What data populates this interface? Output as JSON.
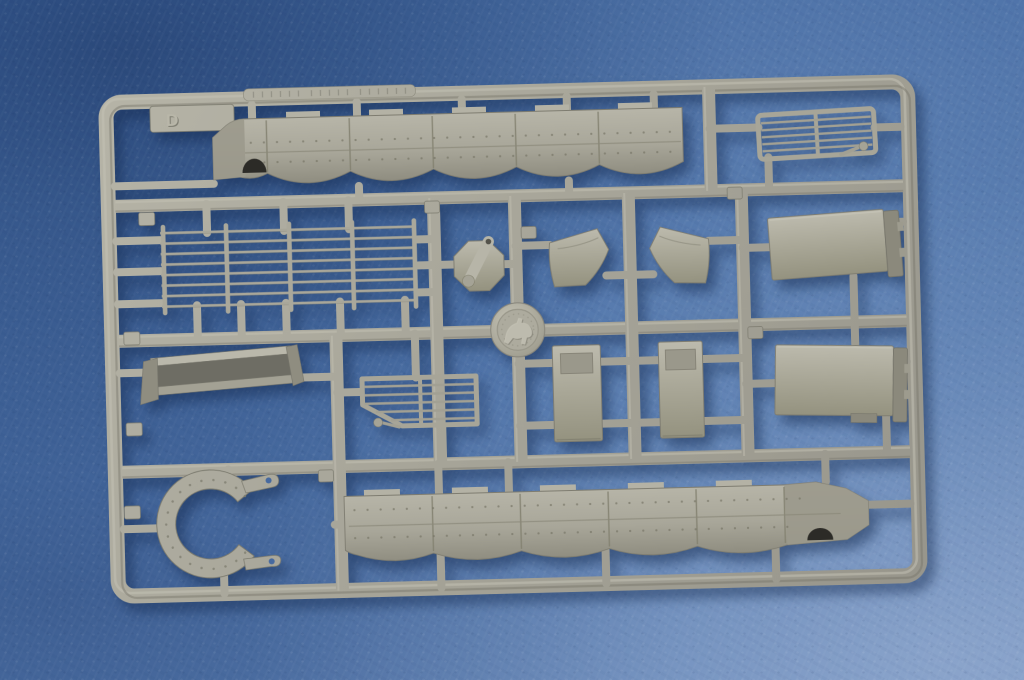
{
  "photo": {
    "subject": "Plastic model-kit parts sprue (runner D) molded in grey styrene, photographed on a mottled blue backdrop",
    "background_color": "#4e73a9",
    "plastic_color": "#a6a498",
    "shadow_color": "#24477f"
  },
  "sprue": {
    "letter": "D",
    "embossed_code_on_top_rail": "illegible",
    "part_number_tag_count": 9,
    "parts": [
      {
        "id": "side-skirt-upper",
        "label": "Segmented side-skirt armour strip, six panels, angled end with dark cable cutout"
      },
      {
        "id": "engine-grille-right",
        "label": "Slatted engine grille with small bracket"
      },
      {
        "id": "mesh-rack",
        "label": "Large open grid rack of thin bars"
      },
      {
        "id": "hatch-with-lever",
        "label": "Octagonal hatch disc with lever arm"
      },
      {
        "id": "mud-flap-left",
        "label": "Curved mud flap, left"
      },
      {
        "id": "mud-flap-right",
        "label": "Curved mud flap, right"
      },
      {
        "id": "stowage-bin-upper",
        "label": "Flat stowage-bin panel with folded latch edge"
      },
      {
        "id": "maker-medallion",
        "label": "Round embossed maker medallion"
      },
      {
        "id": "channel-bracket",
        "label": "Angled channel bracket with end flanges"
      },
      {
        "id": "engine-grille-center",
        "label": "Slatted grille with clipped corner and bracket"
      },
      {
        "id": "hull-plate-left",
        "label": "Rectangular hull plate with recessed panel"
      },
      {
        "id": "hull-plate-right",
        "label": "Rectangular hull plate with recessed panel"
      },
      {
        "id": "stowage-bin-lower",
        "label": "Flat stowage-bin panel with folded latch edge"
      },
      {
        "id": "turret-ring-segment",
        "label": "C-shaped riveted ring with two drilled tab ends"
      },
      {
        "id": "side-skirt-lower",
        "label": "Segmented side-skirt armour strip, six panels, angled end with dark cable cutout"
      }
    ]
  }
}
